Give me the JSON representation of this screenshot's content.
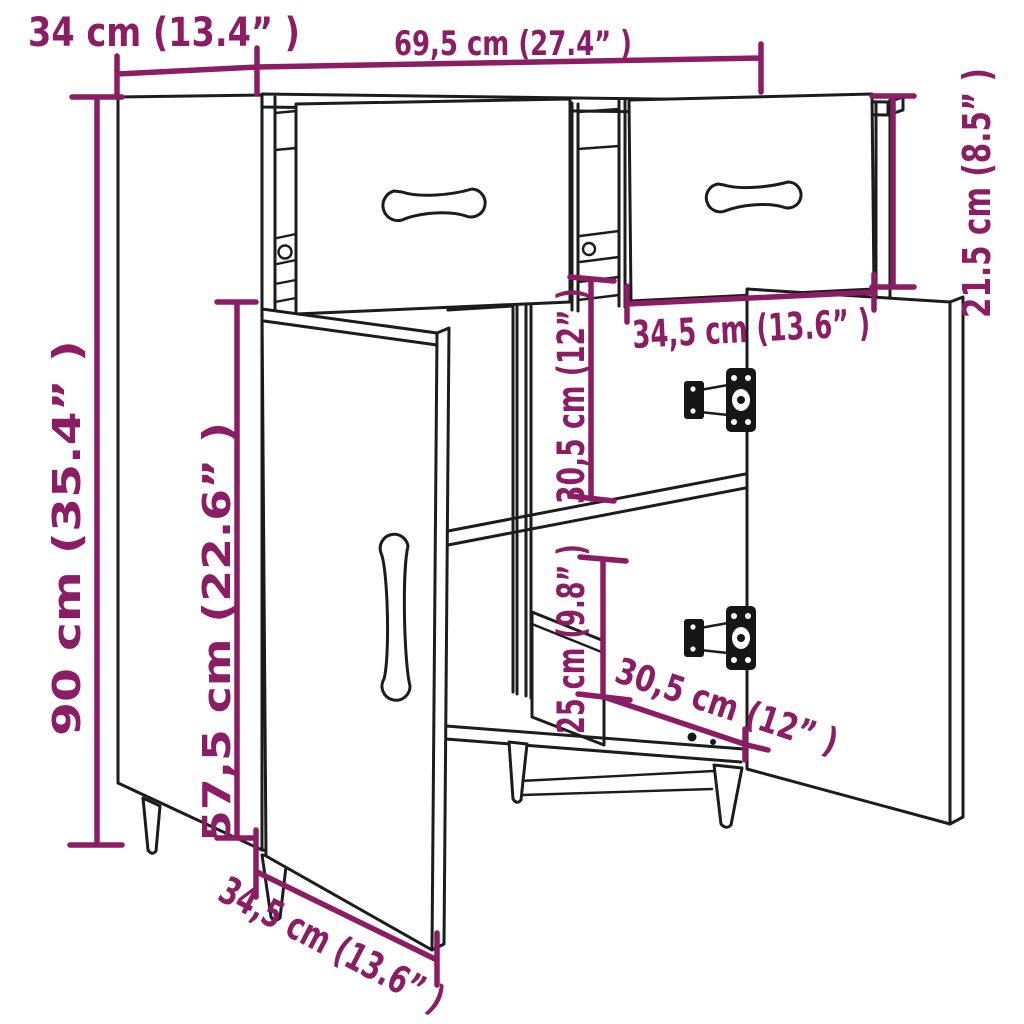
{
  "colors": {
    "accent": "#8b1d64",
    "line": "#1c1c1c",
    "background": "#ffffff"
  },
  "dims": {
    "depth_top": "34 cm (13.4” )",
    "width_top": "69,5 cm (27.4” )",
    "drawer_section_height": "21.5 cm (8.5” )",
    "total_height": "90 cm (35.4” )",
    "door_height": "57,5 cm (22.6” )",
    "upper_compartment_height": "30,5 cm (12” )",
    "compartment_width": "34,5 cm (13.6” )",
    "lower_compartment_height": "25 cm (9.8” )",
    "compartment_depth": "30,5 cm (12” )",
    "door_width": "34,5 cm (13.6” )"
  }
}
